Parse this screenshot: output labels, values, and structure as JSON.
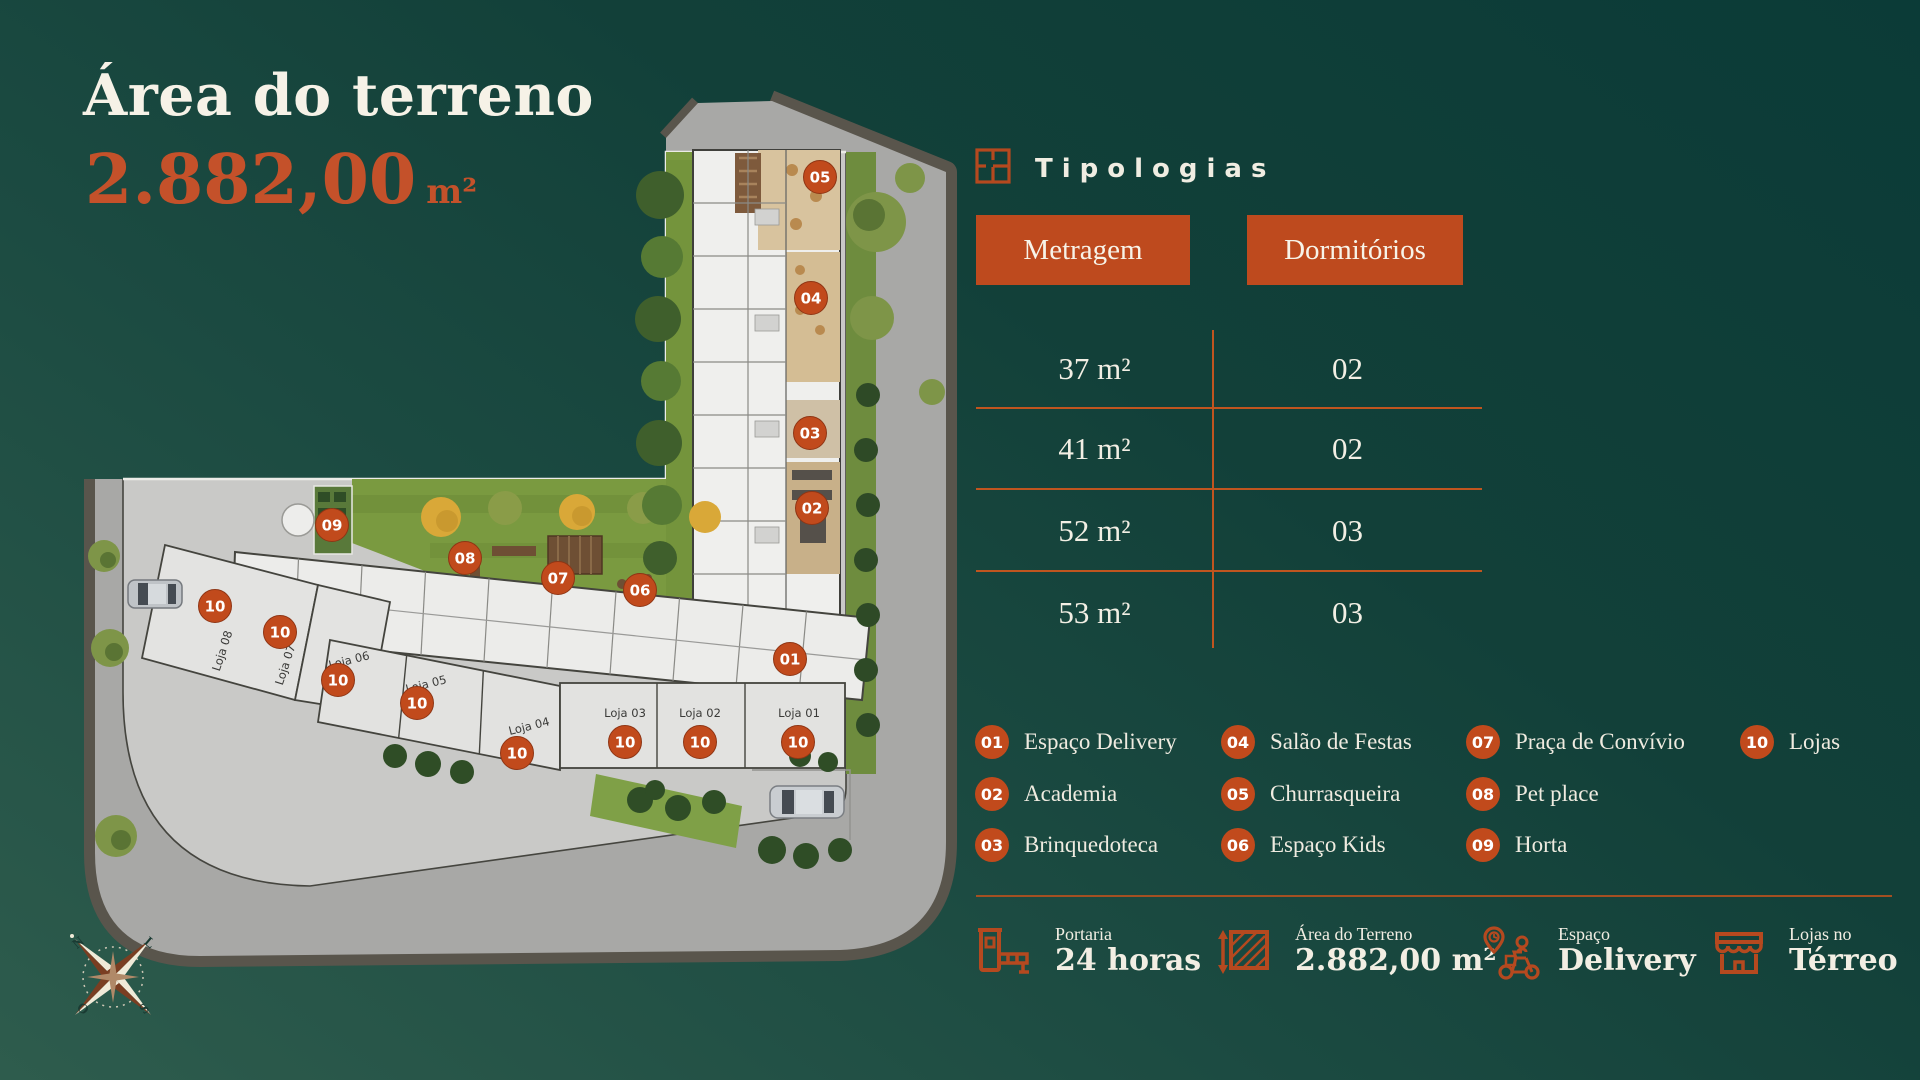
{
  "colors": {
    "background_teal": "#16453e",
    "accent": "#c14a1c",
    "accent_line": "#c0551f",
    "cream_text": "#f2eee3",
    "lawn_green": "#7a9a40",
    "street_gray": "#a8a8a6"
  },
  "header": {
    "title": "Área do terreno",
    "area_value": "2.882,00",
    "area_unit": "m²"
  },
  "typologies": {
    "section_title": "Tipologias",
    "col_metragem": "Metragem",
    "col_dormitorios": "Dormitórios",
    "rows": [
      {
        "metragem": "37 m²",
        "dormitorios": "02"
      },
      {
        "metragem": "41 m²",
        "dormitorios": "02"
      },
      {
        "metragem": "52 m²",
        "dormitorios": "03"
      },
      {
        "metragem": "53 m²",
        "dormitorios": "03"
      }
    ]
  },
  "legend": {
    "items": [
      {
        "num": "01",
        "label": "Espaço Delivery"
      },
      {
        "num": "02",
        "label": "Academia"
      },
      {
        "num": "03",
        "label": "Brinquedoteca"
      },
      {
        "num": "04",
        "label": "Salão de Festas"
      },
      {
        "num": "05",
        "label": "Churrasqueira"
      },
      {
        "num": "06",
        "label": "Espaço Kids"
      },
      {
        "num": "07",
        "label": "Praça de Convívio"
      },
      {
        "num": "08",
        "label": "Pet place"
      },
      {
        "num": "09",
        "label": "Horta"
      },
      {
        "num": "10",
        "label": "Lojas"
      }
    ]
  },
  "features": [
    {
      "icon": "gate-icon",
      "line1": "Portaria",
      "line2": "24 horas"
    },
    {
      "icon": "terrain-area-icon",
      "line1": "Área do Terreno",
      "line2": "2.882,00 m²"
    },
    {
      "icon": "delivery-scooter-icon",
      "line1": "Espaço",
      "line2": "Delivery"
    },
    {
      "icon": "storefront-icon",
      "line1": "Lojas no",
      "line2": "Térreo"
    }
  ],
  "plan": {
    "loja_labels": [
      "Loja 08",
      "Loja 07",
      "Loja 06",
      "Loja 05",
      "Loja 04",
      "Loja 03",
      "Loja 02",
      "Loja 01"
    ],
    "amenity_marker_numbers": [
      "05",
      "04",
      "03",
      "02",
      "01",
      "09",
      "08",
      "07",
      "06"
    ],
    "loja_marker_number": "10",
    "compass": [
      "N",
      "L",
      "S",
      "O"
    ]
  }
}
